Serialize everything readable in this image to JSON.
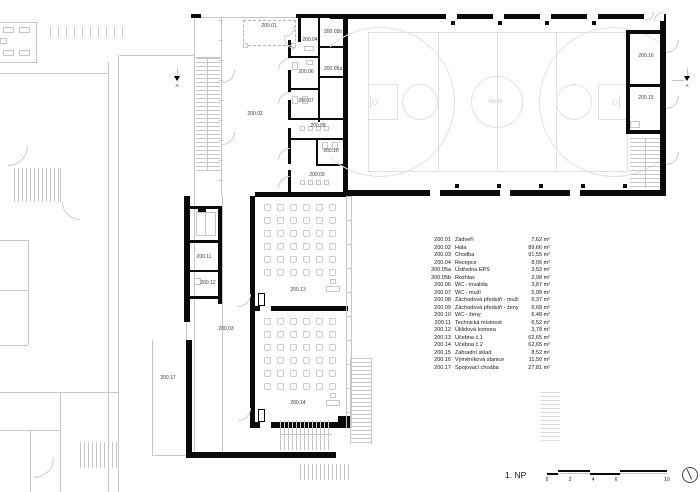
{
  "drawing": {
    "floor_title": "1. NP",
    "section_label": "A"
  },
  "legend": {
    "rows": [
      {
        "num": "200.01",
        "name": "Zádveří",
        "area": "7,62 m²"
      },
      {
        "num": "200.02",
        "name": "Hala",
        "area": "89,66 m²"
      },
      {
        "num": "200.03",
        "name": "Chodba",
        "area": "91,55 m²"
      },
      {
        "num": "200.04",
        "name": "Recepce",
        "area": "8,06 m²"
      },
      {
        "num": "200.05a",
        "name": "Ústředna EPS",
        "area": "3,53 m²"
      },
      {
        "num": "200.05b",
        "name": "Rozhlas",
        "area": "2,98 m²"
      },
      {
        "num": "200.06",
        "name": "WC - invalida",
        "area": "3,87 m²"
      },
      {
        "num": "200.07",
        "name": "WC - muži",
        "area": "5,99 m²"
      },
      {
        "num": "200.08",
        "name": "Záchodová předsíň - muži",
        "area": "6,37 m²"
      },
      {
        "num": "200.09",
        "name": "Záchodová předsíň - ženy",
        "area": "6,68 m²"
      },
      {
        "num": "200.10",
        "name": "WC - ženy",
        "area": "6,48 m²"
      },
      {
        "num": "200.11",
        "name": "Technická místnost",
        "area": "6,52 m²"
      },
      {
        "num": "200.12",
        "name": "Úklidová komora",
        "area": "3,78 m²"
      },
      {
        "num": "200.13",
        "name": "Učebna č.1",
        "area": "62,65 m²"
      },
      {
        "num": "200.14",
        "name": "Učebna č.2",
        "area": "62,65 m²"
      },
      {
        "num": "200.15",
        "name": "Zahradní sklad",
        "area": "8,52 m²"
      },
      {
        "num": "200.16",
        "name": "Výměníková stanice",
        "area": "11,50 m²"
      },
      {
        "num": "200.17",
        "name": "Spojovací chodba",
        "area": "27,81 m²"
      }
    ]
  },
  "plan_labels": [
    {
      "id": "200.01",
      "x": 269,
      "y": 26
    },
    {
      "id": "200.02",
      "x": 255,
      "y": 114
    },
    {
      "id": "200.03",
      "x": 226,
      "y": 329
    },
    {
      "id": "200.04",
      "x": 310,
      "y": 40
    },
    {
      "id": "200.05b",
      "x": 333,
      "y": 32
    },
    {
      "id": "200.05a",
      "x": 333,
      "y": 69
    },
    {
      "id": "200.06",
      "x": 306,
      "y": 72
    },
    {
      "id": "200.07",
      "x": 306,
      "y": 101
    },
    {
      "id": "200.08",
      "x": 318,
      "y": 126
    },
    {
      "id": "200.10",
      "x": 331,
      "y": 151
    },
    {
      "id": "200.09",
      "x": 317,
      "y": 175
    },
    {
      "id": "200.11",
      "x": 204,
      "y": 257
    },
    {
      "id": "200.12",
      "x": 208,
      "y": 283
    },
    {
      "id": "200.13",
      "x": 298,
      "y": 290
    },
    {
      "id": "200.14",
      "x": 298,
      "y": 403
    },
    {
      "id": "200.16",
      "x": 646,
      "y": 56
    },
    {
      "id": "200.15",
      "x": 646,
      "y": 98
    },
    {
      "id": "200.17",
      "x": 168,
      "y": 378
    },
    {
      "id": "100.15",
      "x": 495,
      "y": 101,
      "light": true
    }
  ],
  "scalebar": {
    "ticks": [
      {
        "label": "0",
        "x": 547
      },
      {
        "label": "2",
        "x": 570
      },
      {
        "label": "4",
        "x": 593
      },
      {
        "label": "6",
        "x": 616
      },
      {
        "label": "10",
        "x": 667
      }
    ]
  }
}
